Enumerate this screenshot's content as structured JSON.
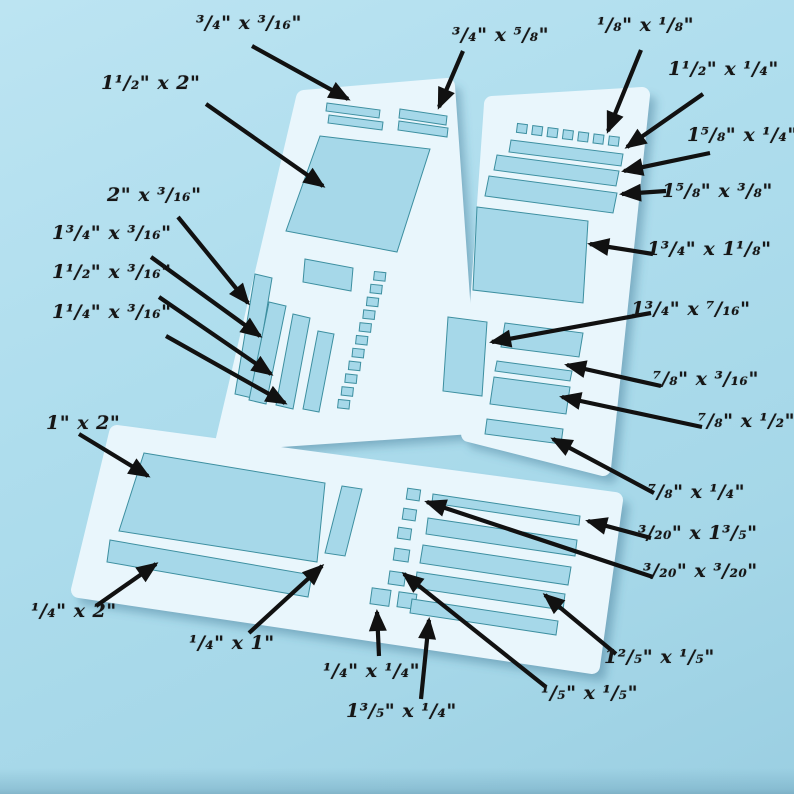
{
  "scene": {
    "description_colors": {
      "background": "#aedded",
      "stencil_panel": "#e9f6fc",
      "cutout_fill": "#a6d8e9",
      "cutout_edge": "#3d8fa0",
      "arrow": "#111111",
      "label_text": "#161616"
    }
  },
  "labels": [
    {
      "id": "l1",
      "text": "³/₄\" x ³/₁₆\""
    },
    {
      "id": "l2",
      "text": "1¹/₂\" x 2\""
    },
    {
      "id": "l3",
      "text": "³/₄\" x ⁵/₈\""
    },
    {
      "id": "l4",
      "text": "¹/₈\" x ¹/₈\""
    },
    {
      "id": "l5",
      "text": "1¹/₂\" x ¹/₄\""
    },
    {
      "id": "l6",
      "text": "1⁵/₈\" x ¹/₄\""
    },
    {
      "id": "l7",
      "text": "1⁵/₈\" x ³/₈\""
    },
    {
      "id": "l8",
      "text": "1³/₄\" x 1¹/₈\""
    },
    {
      "id": "l9",
      "text": "2\" x ³/₁₆\""
    },
    {
      "id": "l10",
      "text": "1³/₄\" x ³/₁₆\""
    },
    {
      "id": "l11",
      "text": "1¹/₂\" x ³/₁₆\""
    },
    {
      "id": "l12",
      "text": "1¹/₄\" x ³/₁₆\""
    },
    {
      "id": "l13",
      "text": "1³/₄\" x ⁷/₁₆\""
    },
    {
      "id": "l14",
      "text": "⁷/₈\" x ³/₁₆\""
    },
    {
      "id": "l15",
      "text": "⁷/₈\" x ¹/₂\""
    },
    {
      "id": "l16",
      "text": "⁷/₈\" x ¹/₄\""
    },
    {
      "id": "l17",
      "text": "³/₂₀\" x 1³/₅\""
    },
    {
      "id": "l18",
      "text": "³/₂₀\" x ³/₂₀\""
    },
    {
      "id": "l19",
      "text": "1\" x 2\""
    },
    {
      "id": "l20",
      "text": "¹/₄\" x 2\""
    },
    {
      "id": "l21",
      "text": "¹/₄\" x 1\""
    },
    {
      "id": "l22",
      "text": "¹/₄\" x ¹/₄\""
    },
    {
      "id": "l23",
      "text": "1³/₅\" x ¹/₄\""
    },
    {
      "id": "l24",
      "text": "¹/₅\" x ¹/₅\""
    },
    {
      "id": "l25",
      "text": "1²/₅\" x ¹/₅\""
    }
  ]
}
